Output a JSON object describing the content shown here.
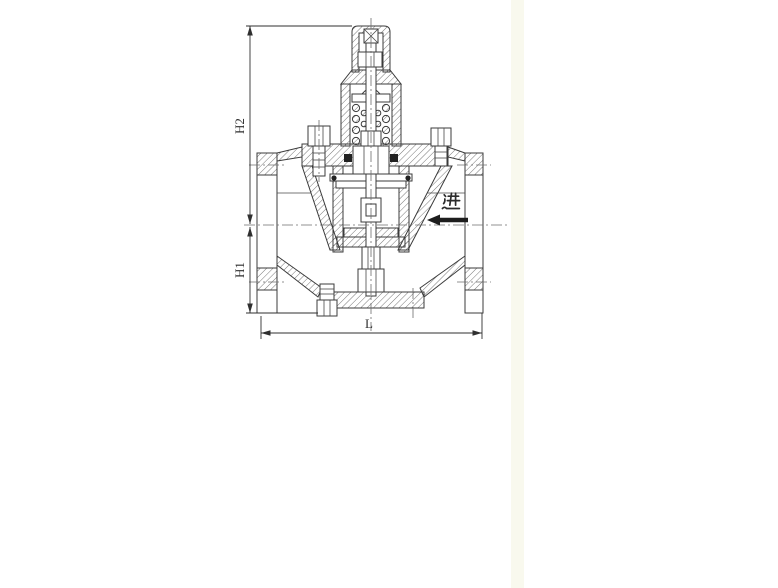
{
  "dimensions": {
    "h2": {
      "label": "H2"
    },
    "h1": {
      "label": "H1"
    },
    "l": {
      "label": "L"
    }
  },
  "flow": {
    "inlet_label": "进",
    "direction": "left"
  },
  "colors": {
    "line": "#3b3b3b",
    "hatch": "#555555",
    "dimension": "#2f2f2f",
    "arrow": "#1d1d1d",
    "background": "#ffffff",
    "tint_strip": "#f9f9ee"
  }
}
